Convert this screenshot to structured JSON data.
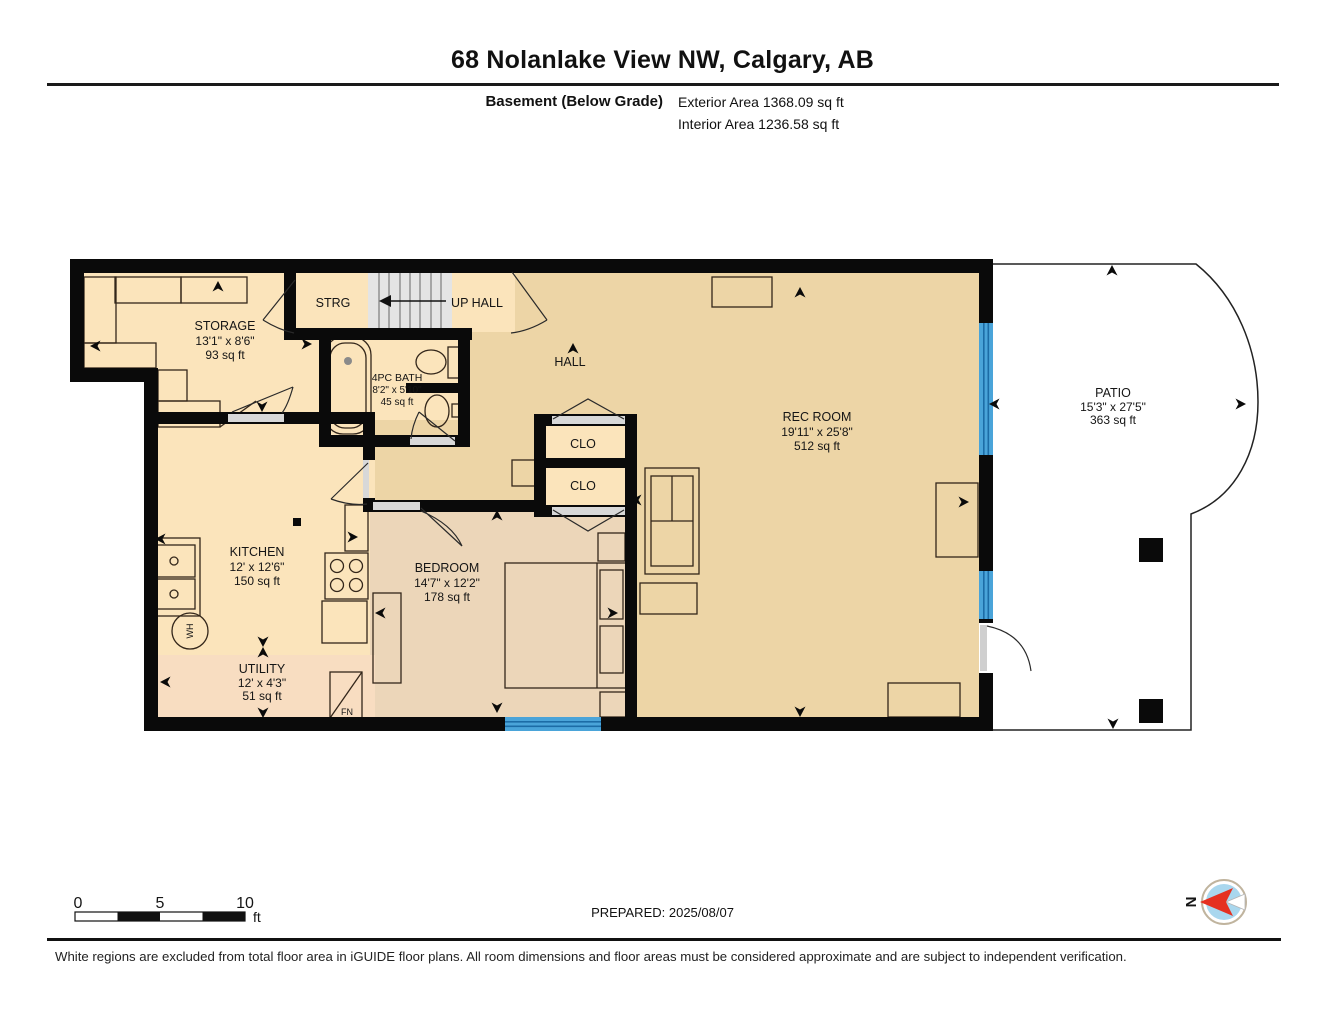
{
  "header": {
    "title": "68 Nolanlake View NW, Calgary, AB",
    "floor_label": "Basement (Below Grade)",
    "exterior_area": "Exterior Area 1368.09 sq ft",
    "interior_area": "Interior Area 1236.58 sq ft"
  },
  "rooms": {
    "storage": {
      "name": "STORAGE",
      "dims": "13'1\" x 8'6\"",
      "area": "93 sq ft"
    },
    "strg": {
      "name": "STRG"
    },
    "up_hall": {
      "name": "UP HALL"
    },
    "bath": {
      "name": "4PC BATH",
      "dims": "8'2\" x 5'10\"",
      "area": "45 sq ft"
    },
    "hall": {
      "name": "HALL"
    },
    "rec_room": {
      "name": "REC ROOM",
      "dims": "19'11\" x 25'8\"",
      "area": "512 sq ft"
    },
    "clo_upper": {
      "name": "CLO"
    },
    "clo_lower": {
      "name": "CLO"
    },
    "kitchen": {
      "name": "KITCHEN",
      "dims": "12' x 12'6\"",
      "area": "150 sq ft"
    },
    "bedroom": {
      "name": "BEDROOM",
      "dims": "14'7\" x 12'2\"",
      "area": "178 sq ft"
    },
    "utility": {
      "name": "UTILITY",
      "dims": "12' x 4'3\"",
      "area": "51 sq ft"
    },
    "patio": {
      "name": "PATIO",
      "dims": "15'3\" x 27'5\"",
      "area": "363 sq ft"
    }
  },
  "fixtures": {
    "water_heater": "WH",
    "furnace": "FN"
  },
  "scale_bar": {
    "tick_0": "0",
    "tick_5": "5",
    "tick_10": "10",
    "unit": "ft"
  },
  "prepared_label": "PREPARED: 2025/08/07",
  "compass": {
    "north": "N"
  },
  "footer": {
    "disclaimer": "White regions are excluded from total floor area in iGUIDE floor plans. All room dimensions and floor areas must be considered approximate and are subject to independent verification."
  },
  "colors": {
    "floor_light": "#fbe4bb",
    "floor_tan": "#edd5a6",
    "floor_bedroom": "#ecd6b9",
    "floor_utility": "#f8ddc1",
    "stairs_gray": "#e4e4e4",
    "window_blue": "#4aa4d9",
    "wall_black": "#0a0a0a",
    "compass_fill": "#a9d7ee",
    "compass_arrow": "#e53020"
  }
}
